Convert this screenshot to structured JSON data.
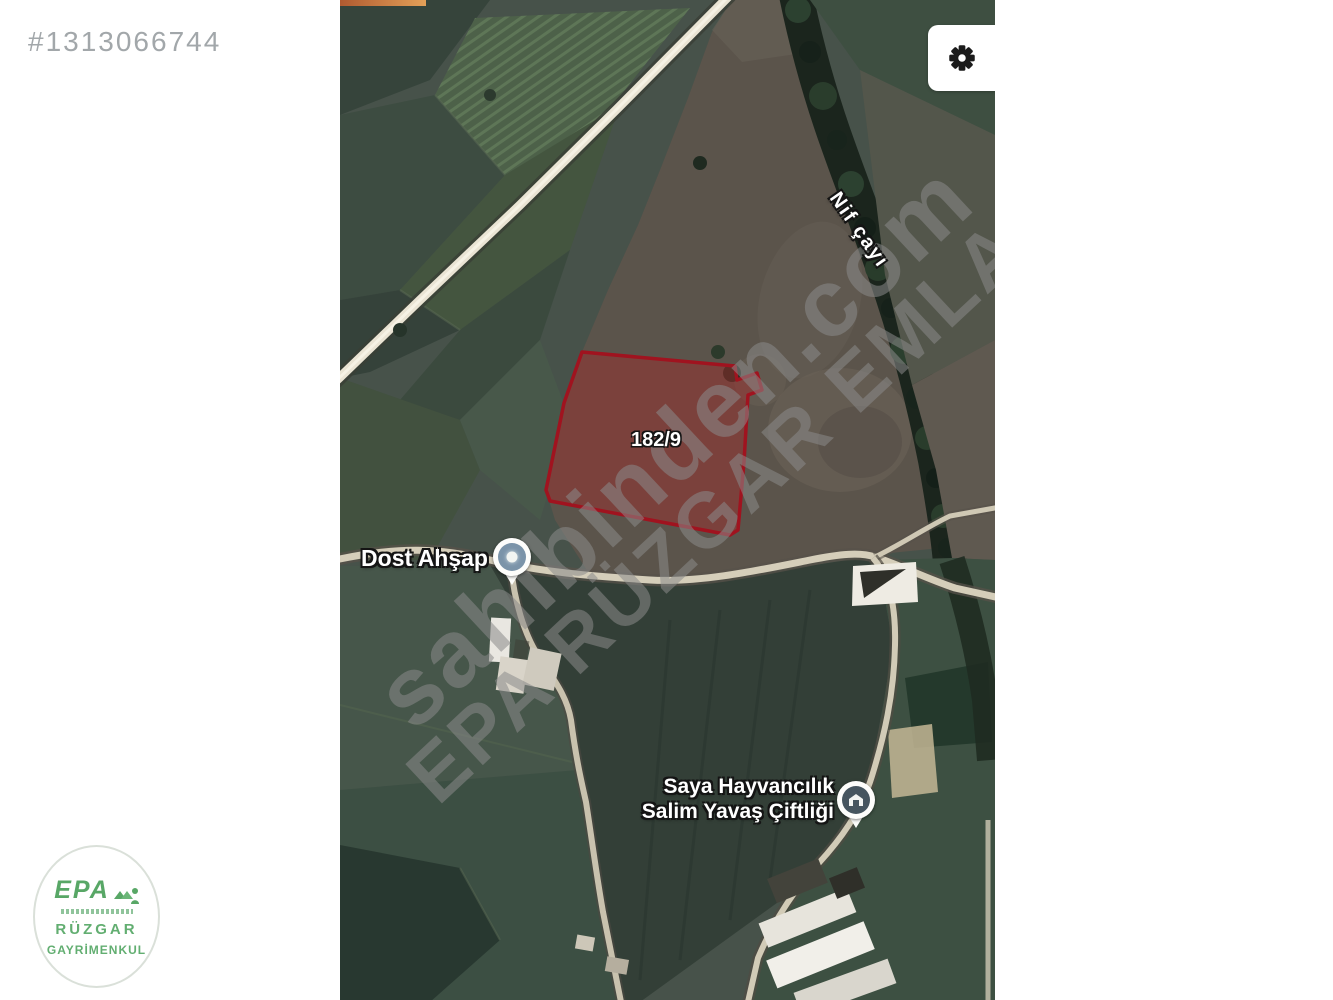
{
  "listing": {
    "id": "#1313066744"
  },
  "map": {
    "parcel": {
      "label": "182/9",
      "stroke_color": "#a0131f",
      "fill_color": "#9b2d2d"
    },
    "pois": {
      "dost": {
        "label": "Dost Ahşap"
      },
      "saya": {
        "label_line1": "Saya Hayvancılık",
        "label_line2": "Salim Yavaş Çiftliği"
      },
      "river": {
        "label": "Nif çayı"
      }
    },
    "watermarks": {
      "primary": "sahibinden.com",
      "secondary": "EPA RÜZGAR EMLAK"
    }
  },
  "branding": {
    "logo_text": "EPA",
    "logo_line1": "RÜZGAR",
    "logo_line2": "GAYRİMENKUL",
    "logo_green": "#4aa05a"
  },
  "colors": {
    "page_bg": "#ffffff",
    "listing_id_text": "#a2a7aa",
    "map_base": "#47524a",
    "road": "#d5ceba",
    "tree_line": "#1b251d"
  }
}
